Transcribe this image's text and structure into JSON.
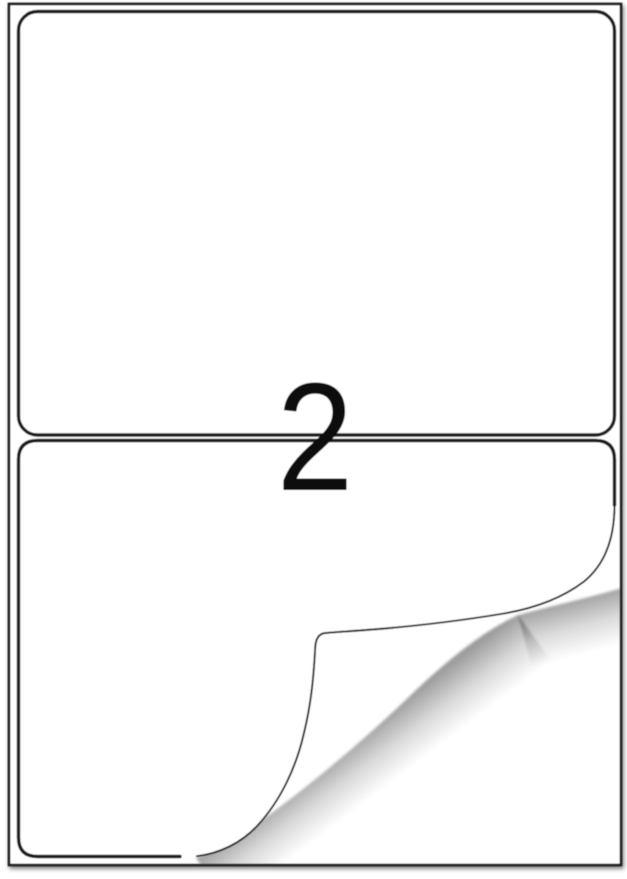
{
  "illustration": {
    "description": "A4 self-adhesive label sheet with two labels, bottom label corner peeling up",
    "count_label": "2",
    "colors": {
      "paper": "#ffffff",
      "border": "#1a1a1a",
      "ink": "#0e0e0e"
    }
  }
}
